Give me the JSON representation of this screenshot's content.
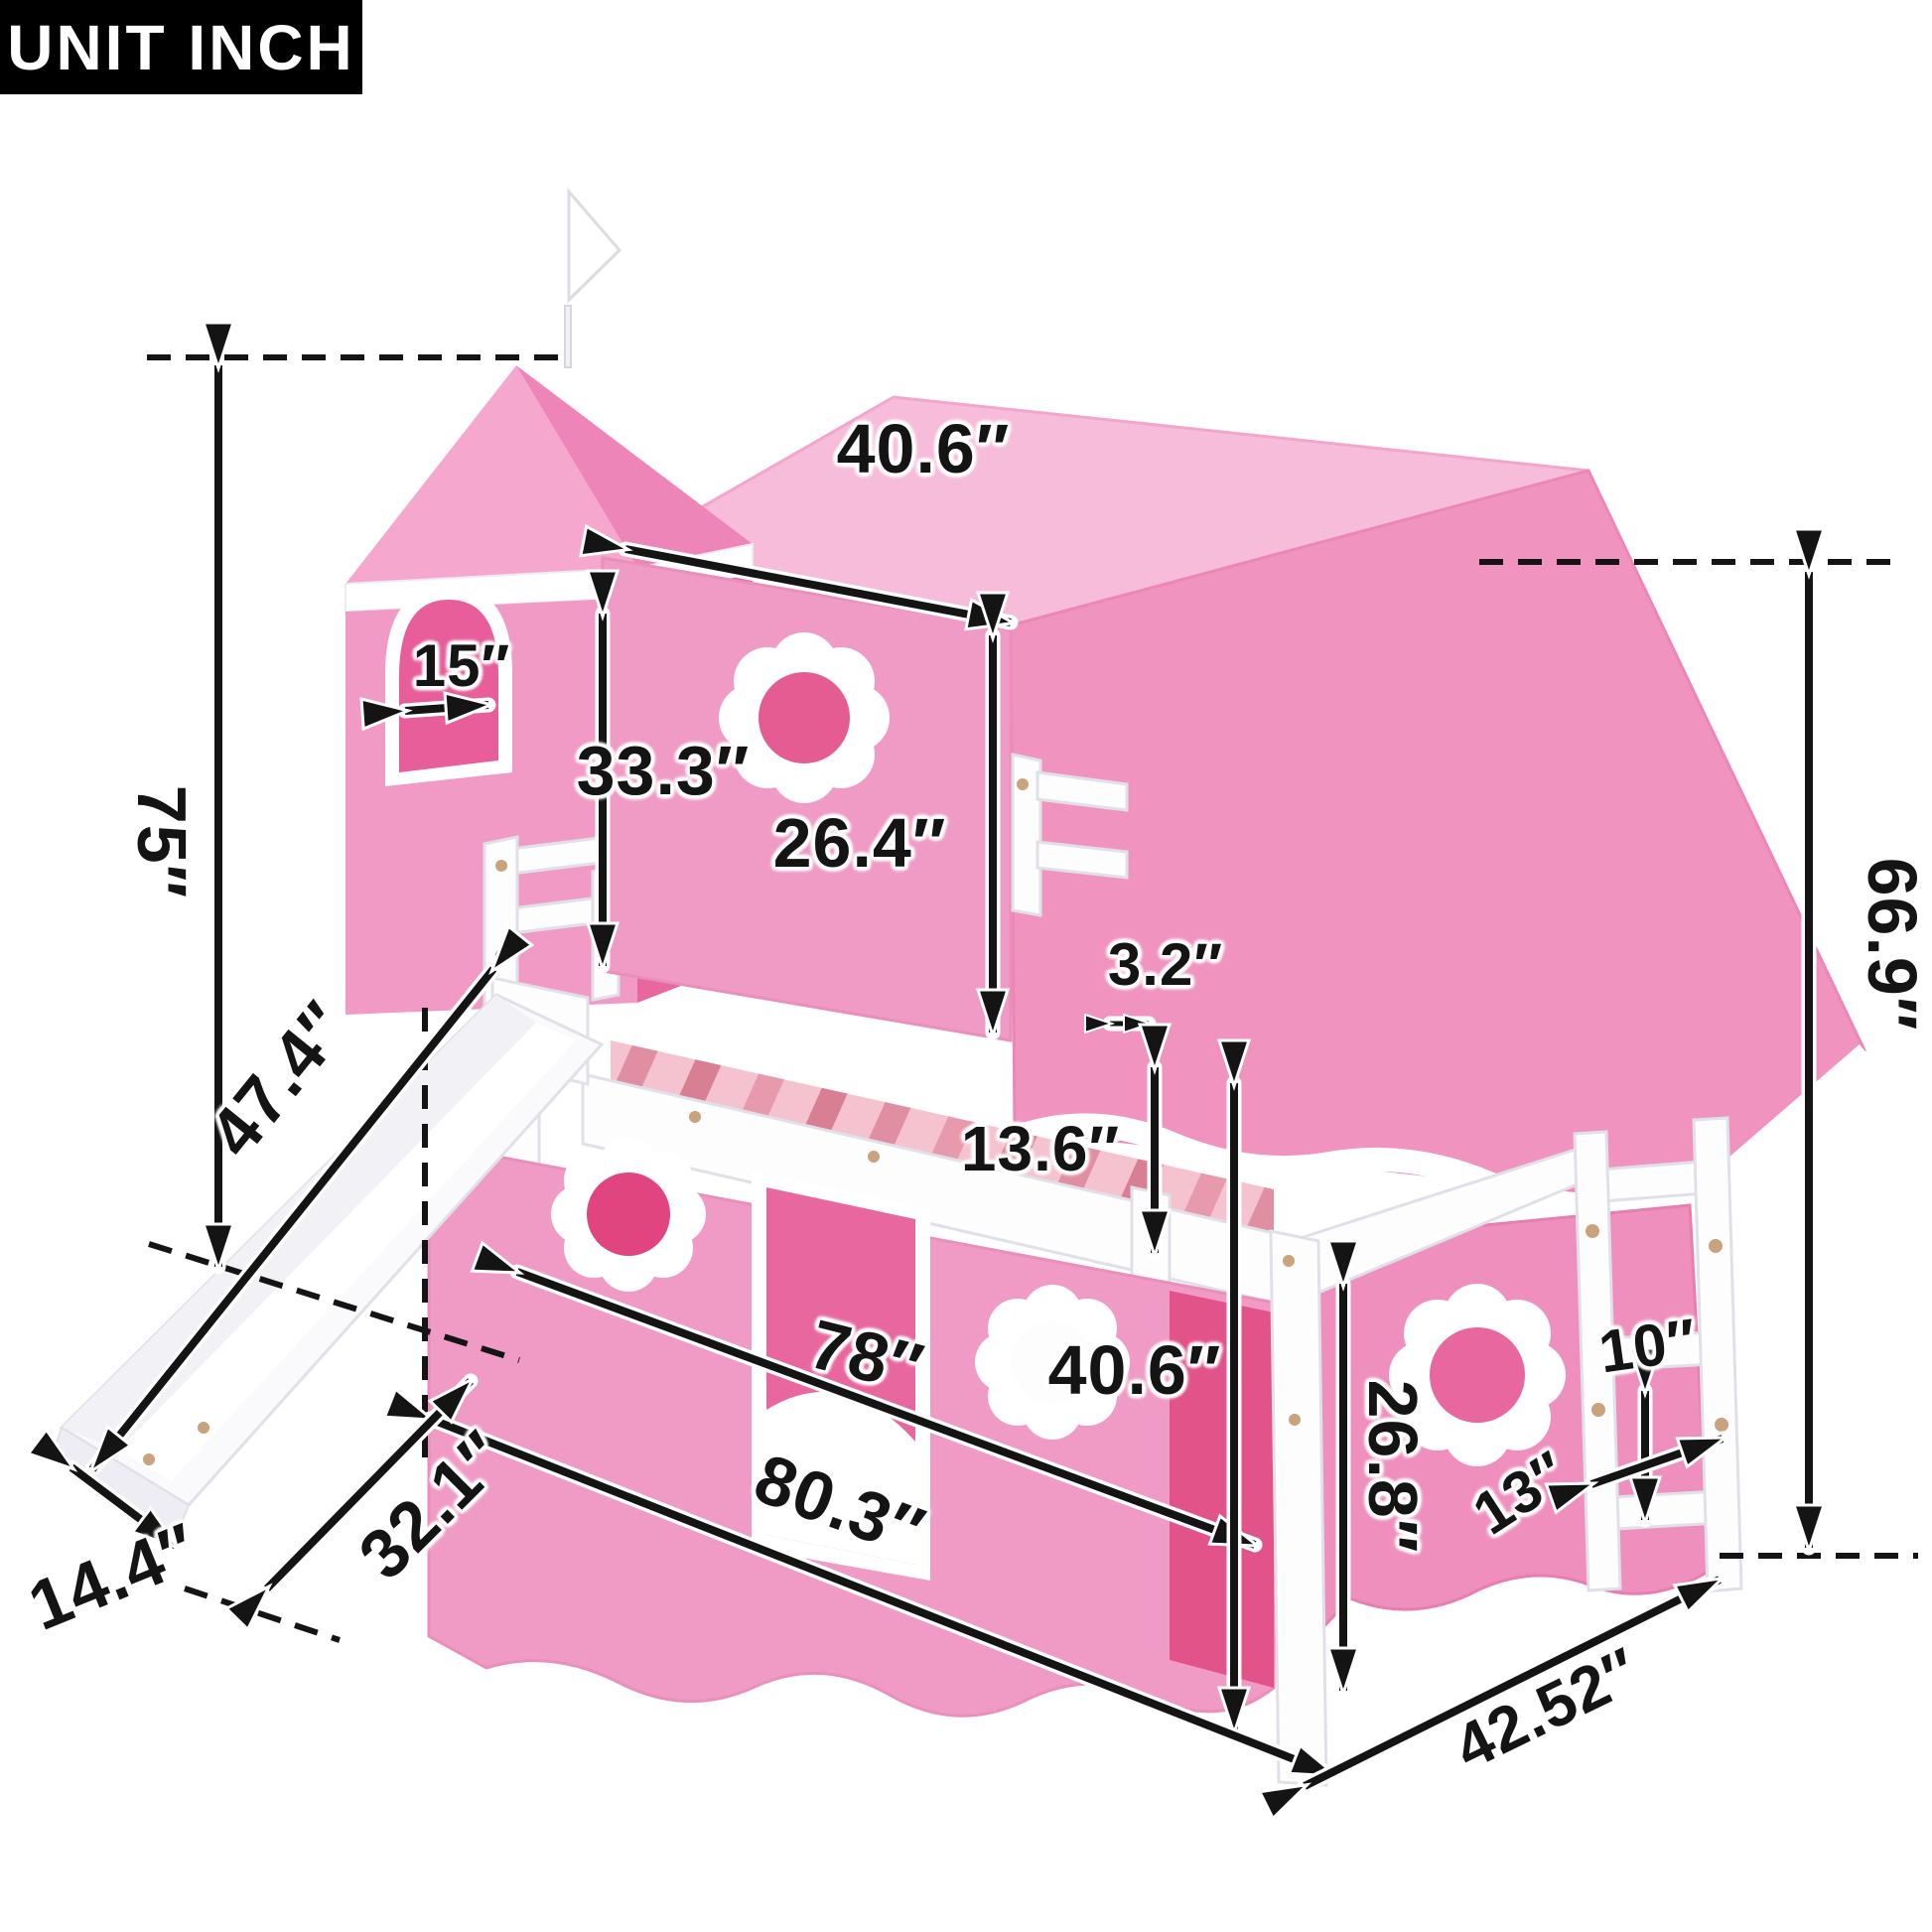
{
  "unit_label": "UNIT INCH",
  "dimensions": {
    "tent_top_width": "40.6″",
    "tower_window_width": "15″",
    "overall_height": "75″",
    "front_curtain_height": "33.3″",
    "tent_opening_height": "26.4″",
    "slat_thickness": "3.2″",
    "guardrail_height": "13.6″",
    "slide_length": "47.4″",
    "bed_length": "78″",
    "under_bed_curtain_height": "40.6″",
    "overall_length": "80.3″",
    "slide_footprint_depth": "32.1″",
    "slide_width": "14.4″",
    "lower_curtain_height": "26.8″",
    "ladder_rung_spacing": "10″",
    "ladder_width": "13″",
    "frame_height": "66.9″",
    "bed_depth": "42.52″"
  },
  "colors": {
    "label_text": "#141414",
    "tent_pink": "#F193BF",
    "tent_top_pink": "#F7BCDA",
    "curtain_pink": "#F09BC5",
    "inner_pink": "#E9679F",
    "accent_deep_pink": "#E0457F",
    "frame_white": "#FFFFFF",
    "background": "#FFFFFF"
  }
}
